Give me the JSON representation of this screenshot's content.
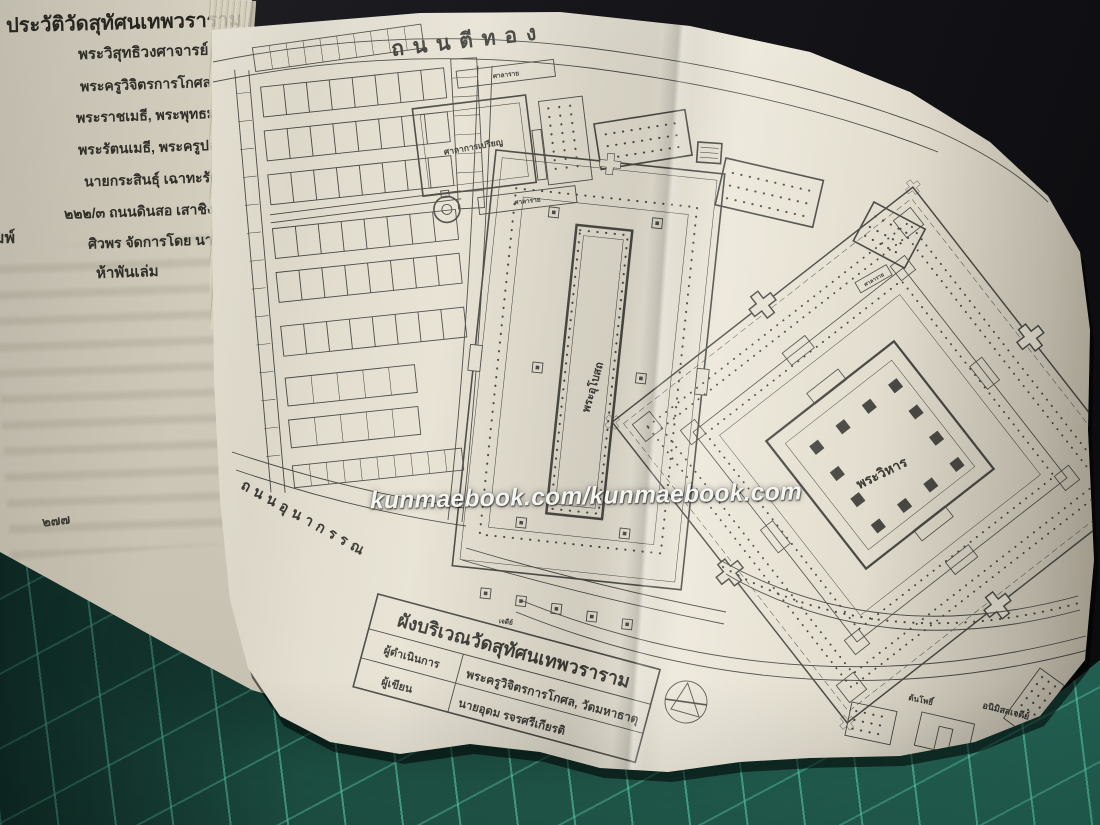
{
  "scene": {
    "backdrop_color": "#17171b",
    "mat_color": "#1e5144",
    "mat_grid_color": "#60d6b5",
    "left_page_color": "#d6d0be",
    "foldout_color": "#e7e2d3",
    "plan_ink_color": "#4a4944",
    "text_ink_color": "#2f2e28"
  },
  "left_page": {
    "title": "ประวัติวัดสุทัศนเทพวราราม",
    "lines": [
      "พระวิสุทธิวงศาจารย์",
      "พระครูวิจิตรการโกศล วัดมหาธาตุ คณะ ๑",
      "พระราชเมธี, พระพุทธมนต์วราจารย์",
      "พระรัตนเมธี, พระครูปลัดสุวัฒนวงศ์",
      "นายกระสินธุ์ เฉาทะรัตน์ ห้องภาพ",
      "๒๒๒/๓ ถนนดินสอ เสาชิงช้า พระนคร",
      "ศิวพร จัดการโดย นายจรัส วีระวัฒน์",
      "ห้าพันเล่ม"
    ],
    "margin_fragment": "มพ์",
    "page_number": "๒๗๗"
  },
  "watermark": "kunmaebook.com/kunmaebook.com",
  "plan": {
    "street_top": "ถนนตีทอง",
    "street_left": "ถนนอุนากรรณ",
    "labels": {
      "sermon_hall": "ศาลาการเปรียญ",
      "sala_rai_top": "ศาลาราย",
      "sala_rai_bottom": "ศาลาราย",
      "sala_rai_east": "ศาลาราย",
      "ubosot": "พระอุโบสถ",
      "wihan": "พระวิหาร",
      "chedi_row": "เจดีย์",
      "bodhi_tree": "ต้นโพธิ์",
      "animis_chedi": "อนิมิสสเจดีย์"
    },
    "title_table": {
      "title": "ผังบริเวณวัดสุทัศนเทพวราราม",
      "rows": [
        {
          "label": "ผู้ดำเนินการ",
          "value": "พระครูวิจิตรการโกศล, วัดมหาธาตุ"
        },
        {
          "label": "ผู้เขียน",
          "value": "นายอุดม รจรศรีเกียรติ"
        }
      ]
    }
  }
}
